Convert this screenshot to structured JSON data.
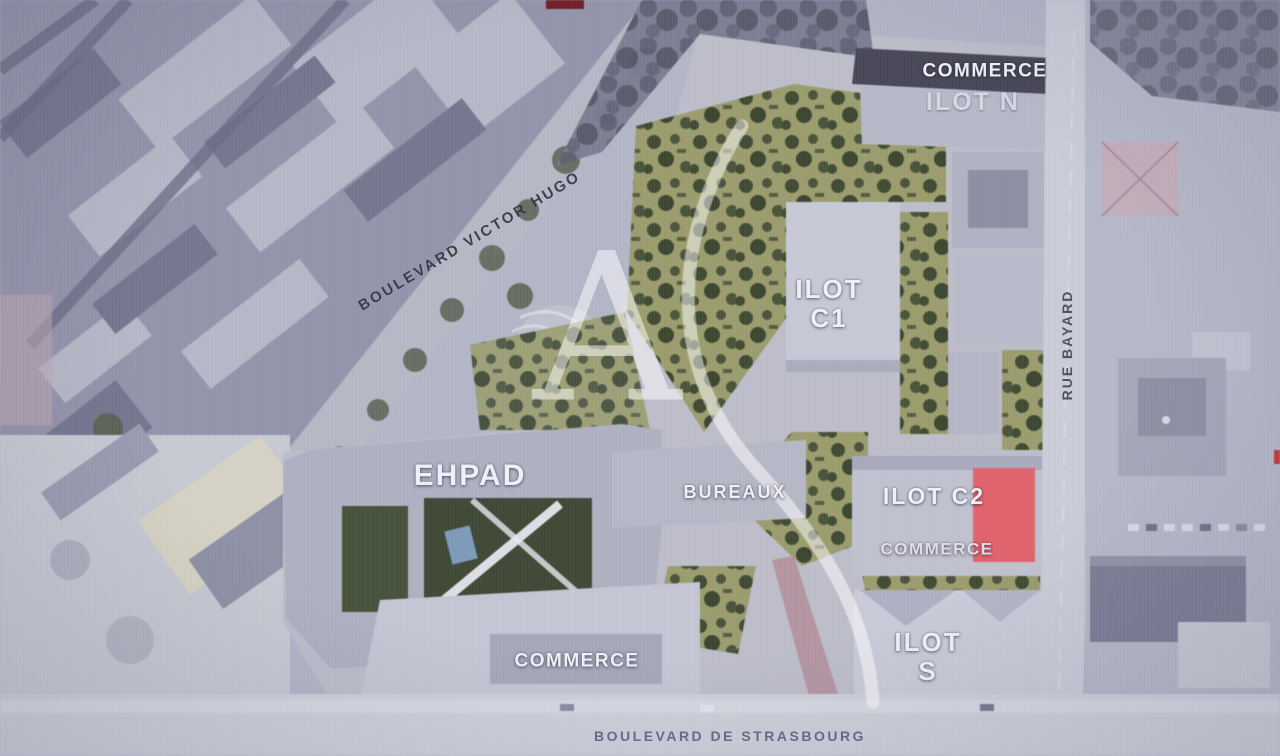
{
  "map": {
    "streets": {
      "boulevard_victor_hugo": "BOULEVARD VICTOR HUGO",
      "rue_bayard": "RUE BAYARD",
      "boulevard_de_strasbourg": "BOULEVARD DE STRASBOURG"
    },
    "blocks": {
      "ilot_n": {
        "title": "ILOT N",
        "tag": "COMMERCE"
      },
      "ilot_c1": {
        "title": "ILOT\nC1"
      },
      "ilot_c2": {
        "title": "ILOT C2",
        "tag": "COMMERCE"
      },
      "ilot_s": {
        "title": "ILOT\nS"
      },
      "ehpad": {
        "title": "EHPAD"
      },
      "bureaux": {
        "title": "BUREAUX"
      },
      "commerce_south": {
        "title": "COMMERCE"
      }
    },
    "watermark_letter": "A",
    "colors": {
      "highlight_red": "#e0626c",
      "plan_green": "#9a9c6e"
    }
  }
}
